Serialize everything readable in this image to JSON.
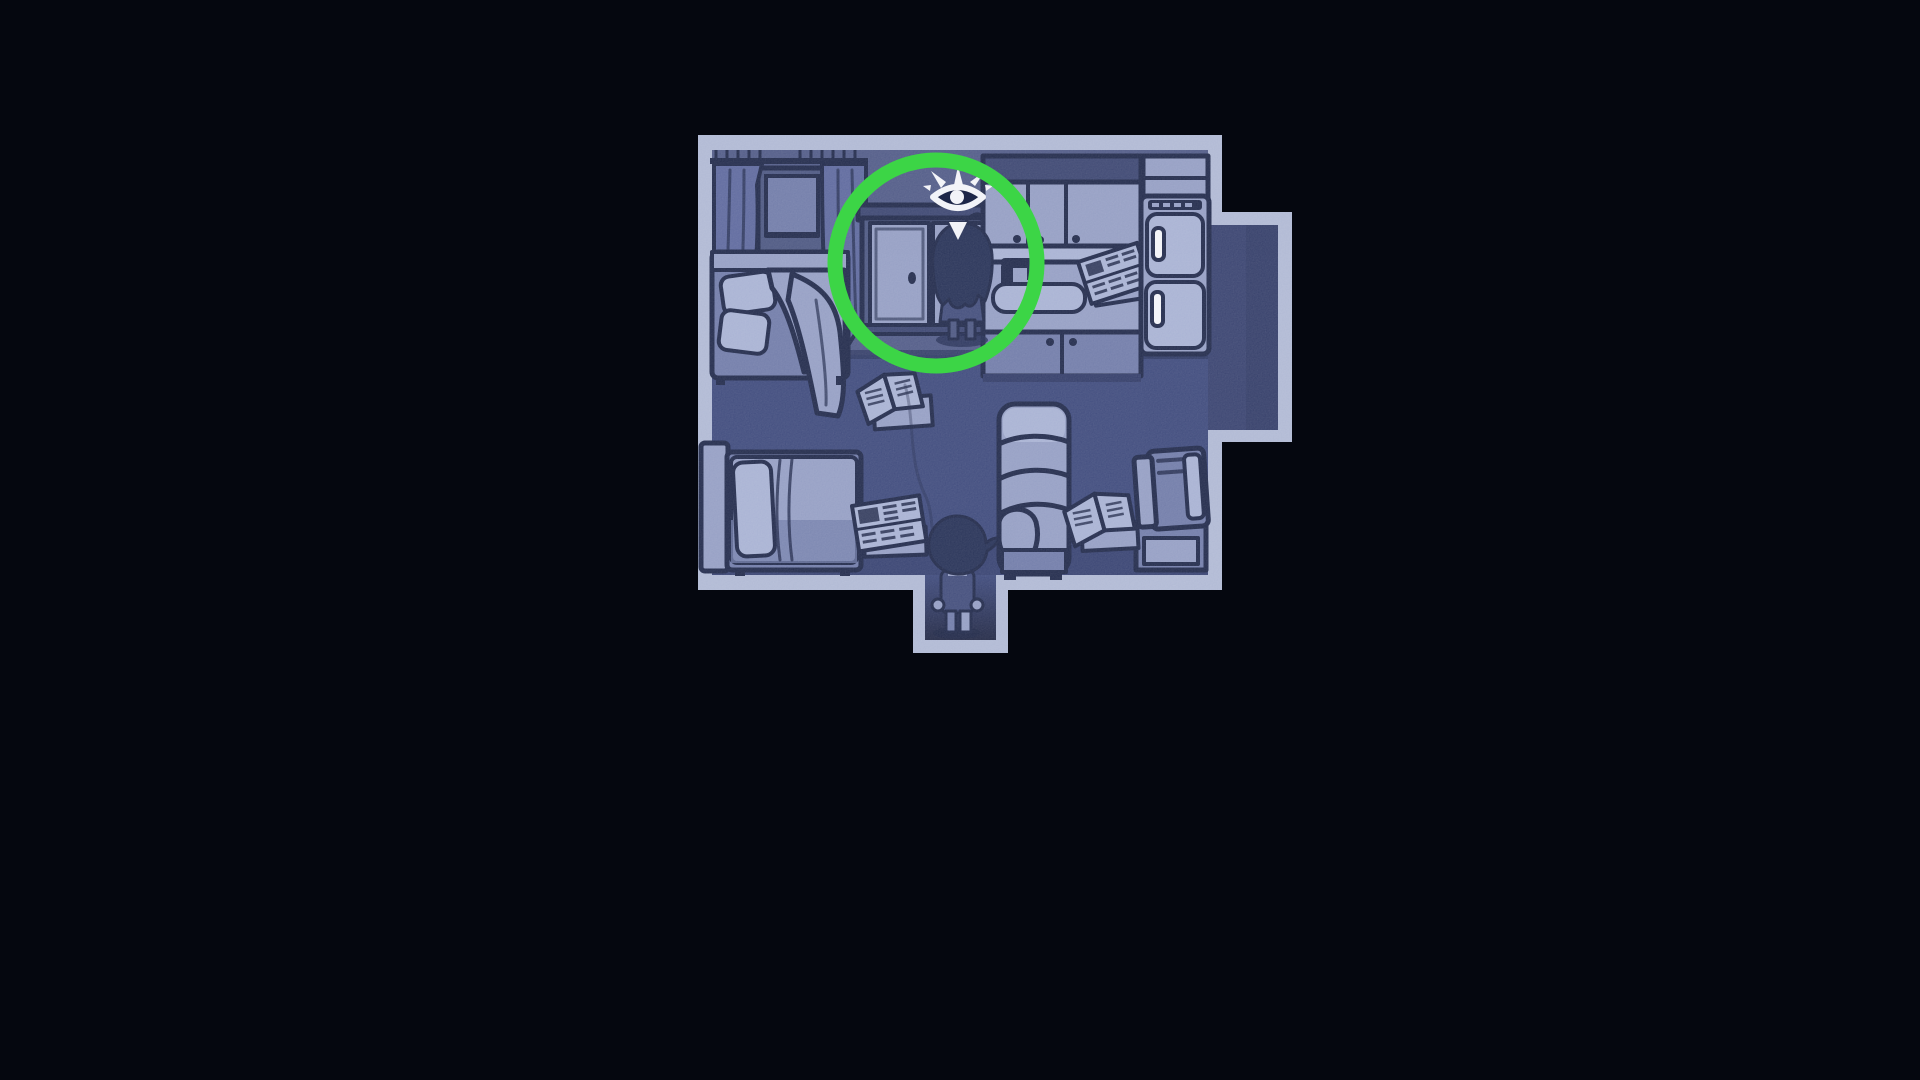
{
  "scene": {
    "description": "Dark night-time top-down game room rendered in monochrome blue. A long-haired character stands at a closet in the kitchen area, highlighted by a bright green circle annotation with a white eye interaction indicator floating above. A second short-haired character stands in the doorway at the bottom of the room. The room contains two beds, a window with curtains, kitchen cabinets with a sink, a refrigerator, an armchair, a TV on a stand, and newspapers scattered across the floor.",
    "view": "top-down room",
    "lighting": "night / monochrome blue"
  },
  "hud": {
    "interaction_indicator": "eye-with-lashes-and-pointer"
  },
  "annotation": {
    "shape": "highlight-circle",
    "color": "#3cd546"
  },
  "characters": [
    {
      "id": "highlighted-character",
      "hair": "long",
      "pose": "standing facing closet",
      "location": "kitchen / closet, inside green circle"
    },
    {
      "id": "player-character",
      "hair": "short",
      "pose": "standing facing up",
      "location": "bottom doorway"
    }
  ],
  "furniture": [
    "window-with-curtains",
    "bed-top-left",
    "closet",
    "upper-cabinets",
    "sink-counter",
    "counter-newspaper",
    "refrigerator",
    "alcove",
    "bed-bottom-left",
    "armchair",
    "tv-on-stand",
    "floor-papers-top",
    "floor-papers-left",
    "floor-papers-right"
  ],
  "palette": {
    "bg": "#05070f",
    "wall_border": "#aeb7d3",
    "wall_face": "#4e5885",
    "floor": "#3b477a",
    "floor_shadow": "#2c3661",
    "alcove_floor": "#353f6d",
    "furniture_light": "#929cc2",
    "furniture_lighter": "#a6b0d2",
    "furniture_mid": "#6e79a7",
    "furniture_deep": "#49547f",
    "furniture_dark": "#39436f",
    "curtain": "#5b669c",
    "outline": "#1d2648",
    "silhouette": "#232e54",
    "char_body": "#3f4a79",
    "white": "#f2f3f8",
    "green": "#3cd546"
  }
}
